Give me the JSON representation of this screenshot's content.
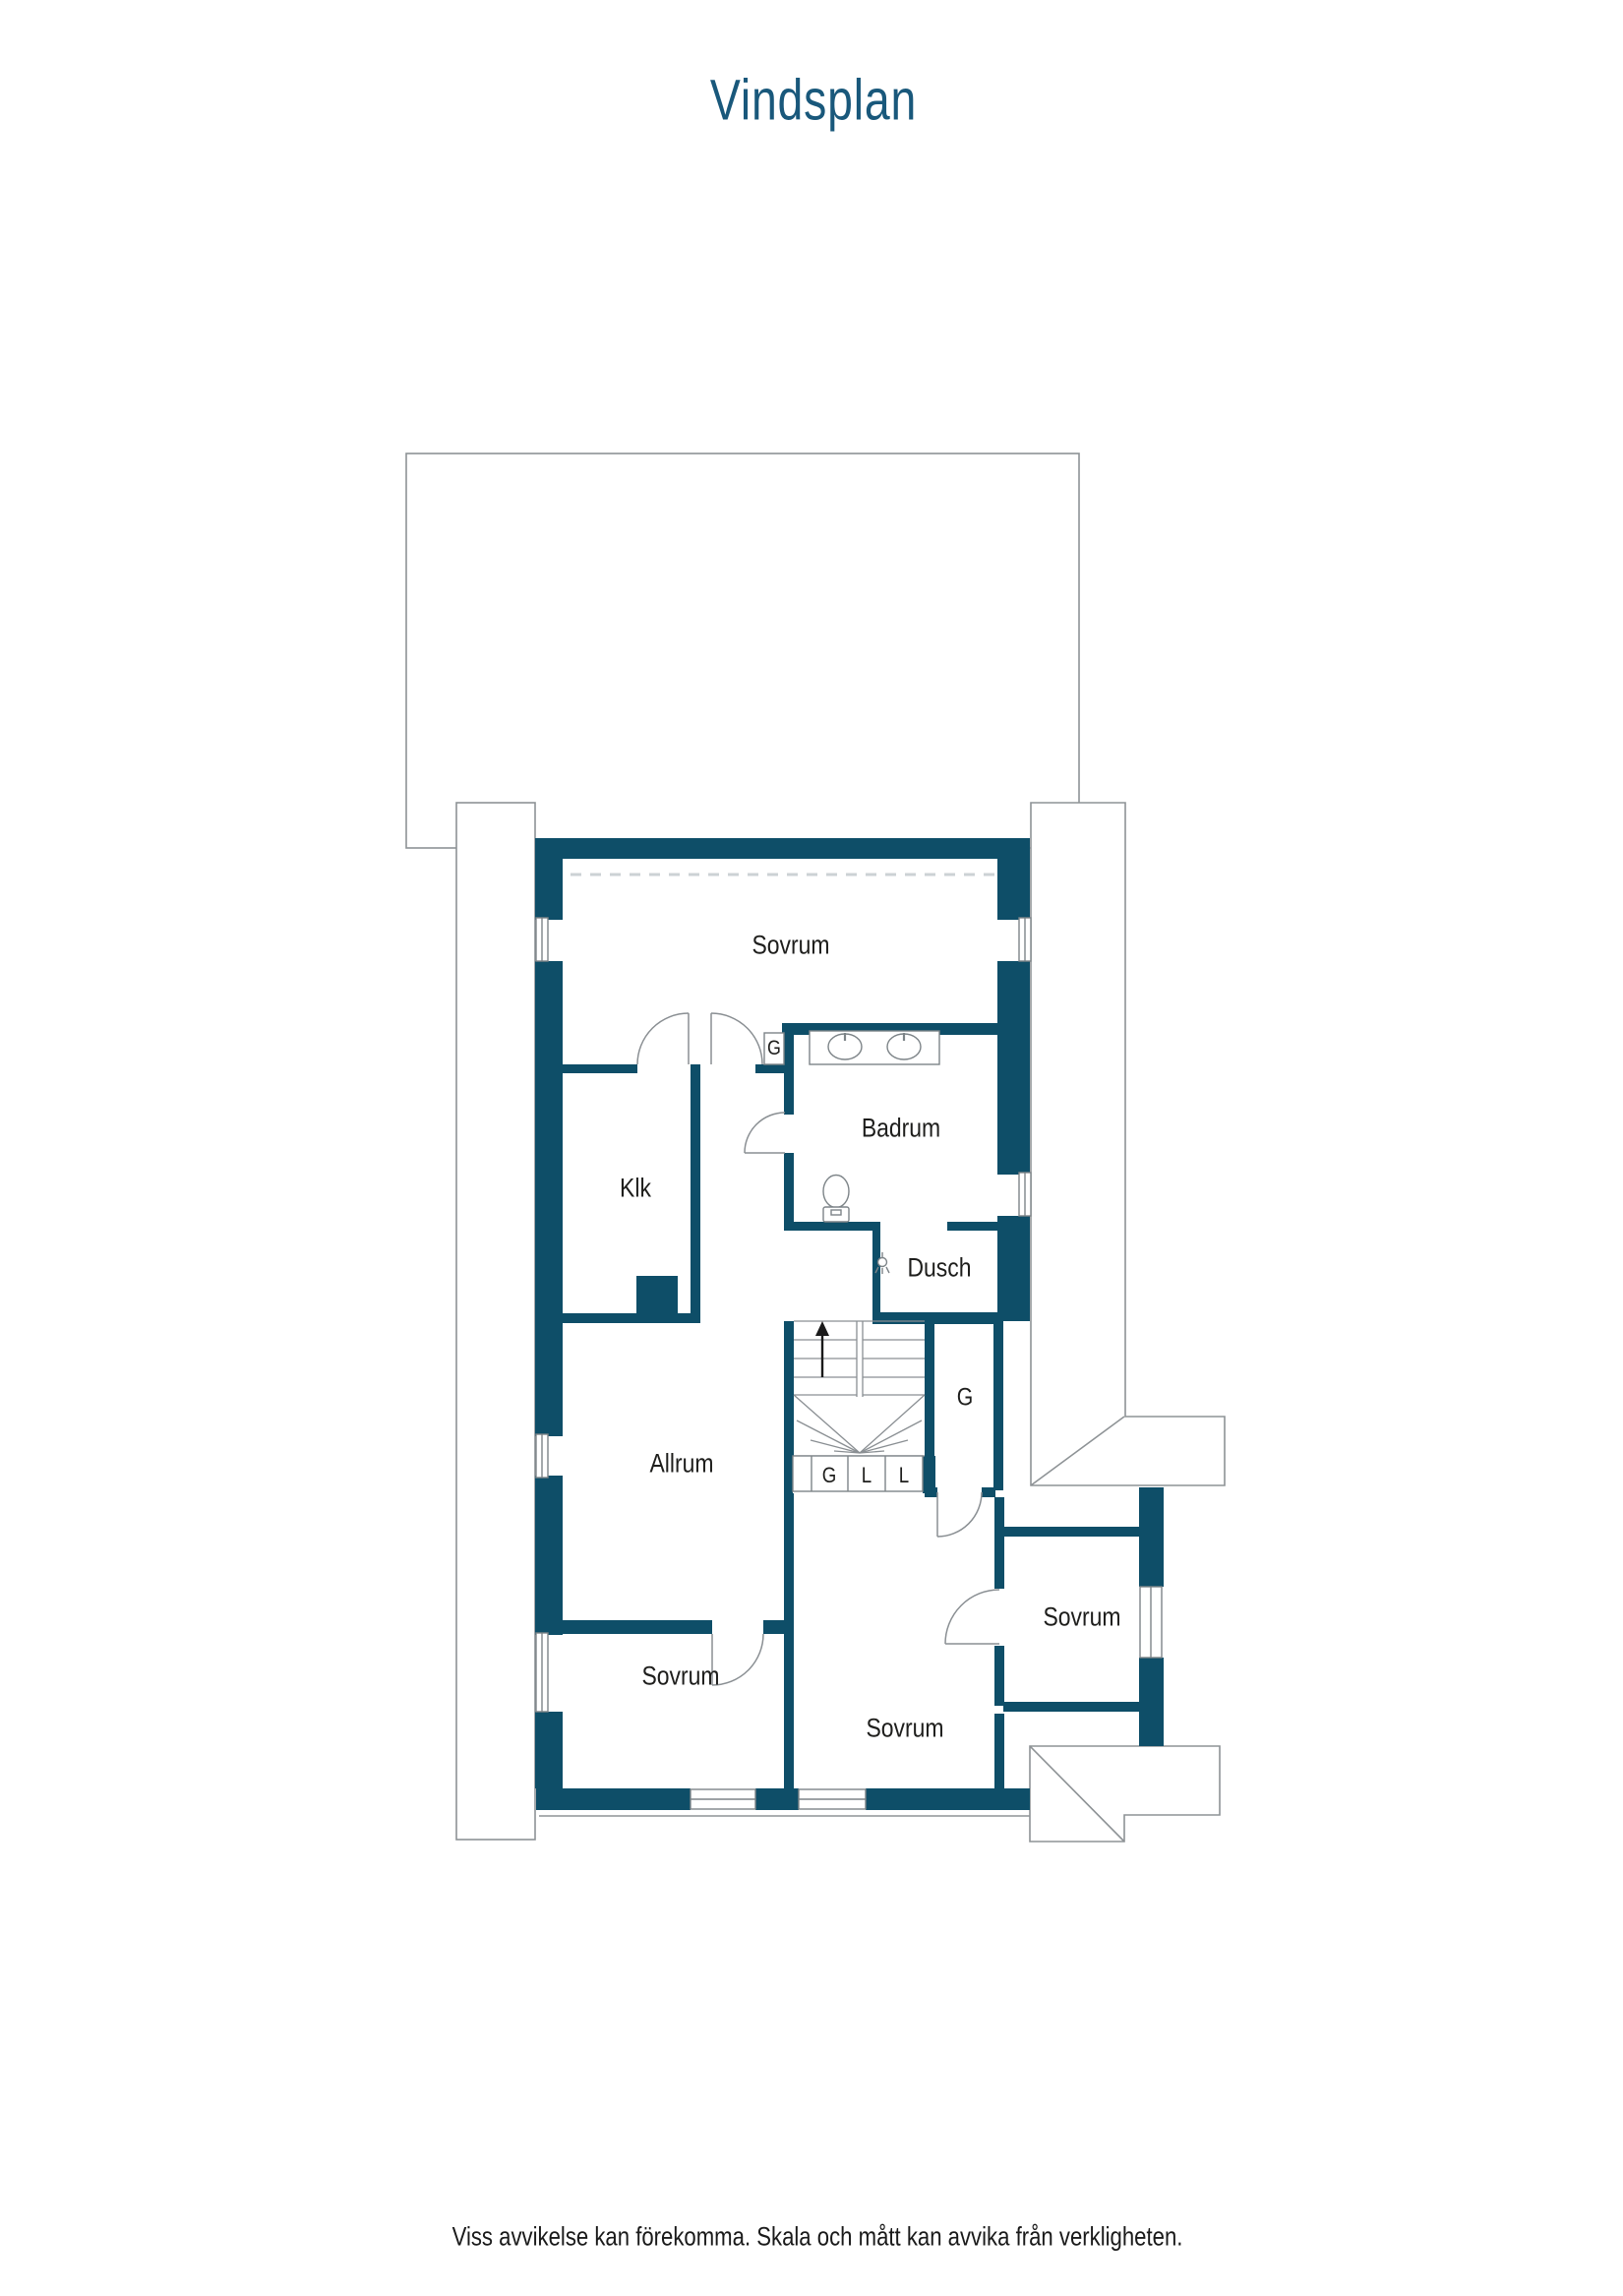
{
  "title": "Vindsplan",
  "plan": {
    "rooms": {
      "sovrum_top": "Sovrum",
      "badrum": "Badrum",
      "klk": "Klk",
      "dusch": "Dusch",
      "allrum": "Allrum",
      "sovrum_bottom_left": "Sovrum",
      "sovrum_bottom_middle": "Sovrum",
      "sovrum_bottom_right": "Sovrum"
    },
    "wardrobes": {
      "hall_g": "G",
      "stair_g": "G"
    },
    "closet_row": [
      "G",
      "L",
      "L"
    ]
  },
  "colors": {
    "wall": "#0e4e68",
    "outline": "#8e9396",
    "title_text": "#19587b",
    "label_text": "#1e1e1c"
  },
  "footer": {
    "disclaimer": "Viss avvikelse kan förekomma. Skala och mått kan avvika från verkligheten."
  }
}
